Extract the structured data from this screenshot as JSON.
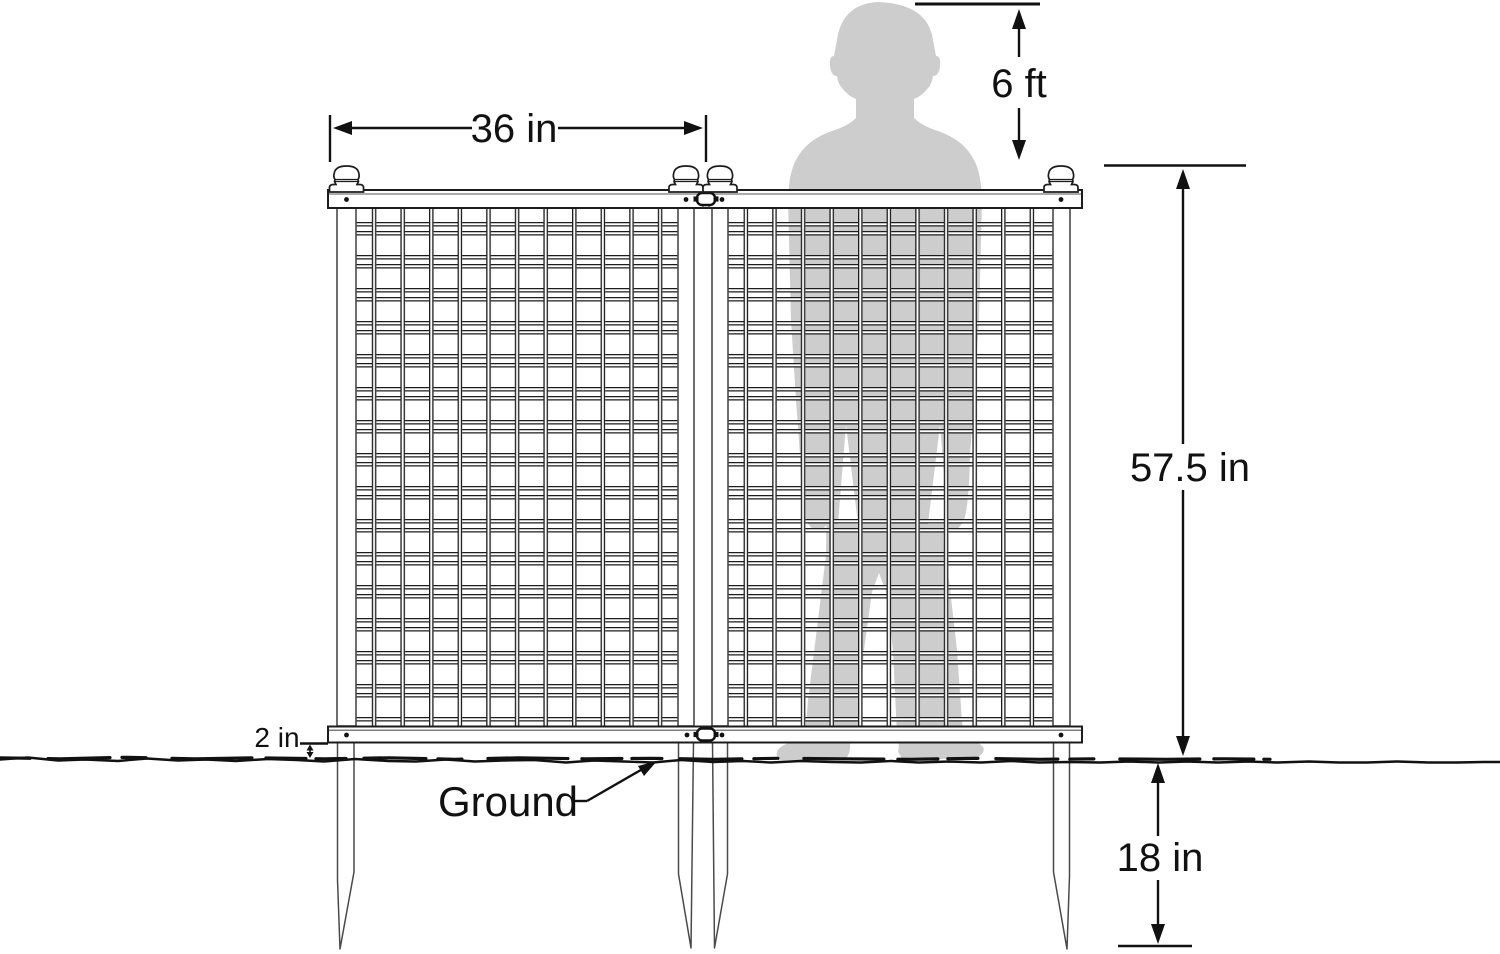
{
  "diagram": {
    "type": "product-dimension-diagram",
    "subject": "Two-panel garden fence with ground stakes, human silhouette shown for scale",
    "dimensions": {
      "panel_width": "36 in",
      "person_height": "6 ft",
      "fence_height_above_ground": "57.5 in",
      "stake_depth_below_ground": "18 in",
      "rail_to_ground_gap": "2 in"
    },
    "labels": {
      "ground": "Ground"
    },
    "colors": {
      "line": "#111111",
      "fence_stroke": "#1c1c1c",
      "post_stroke": "#4a4a4a",
      "silhouette": "#cdcdcd",
      "background": "#ffffff"
    }
  }
}
